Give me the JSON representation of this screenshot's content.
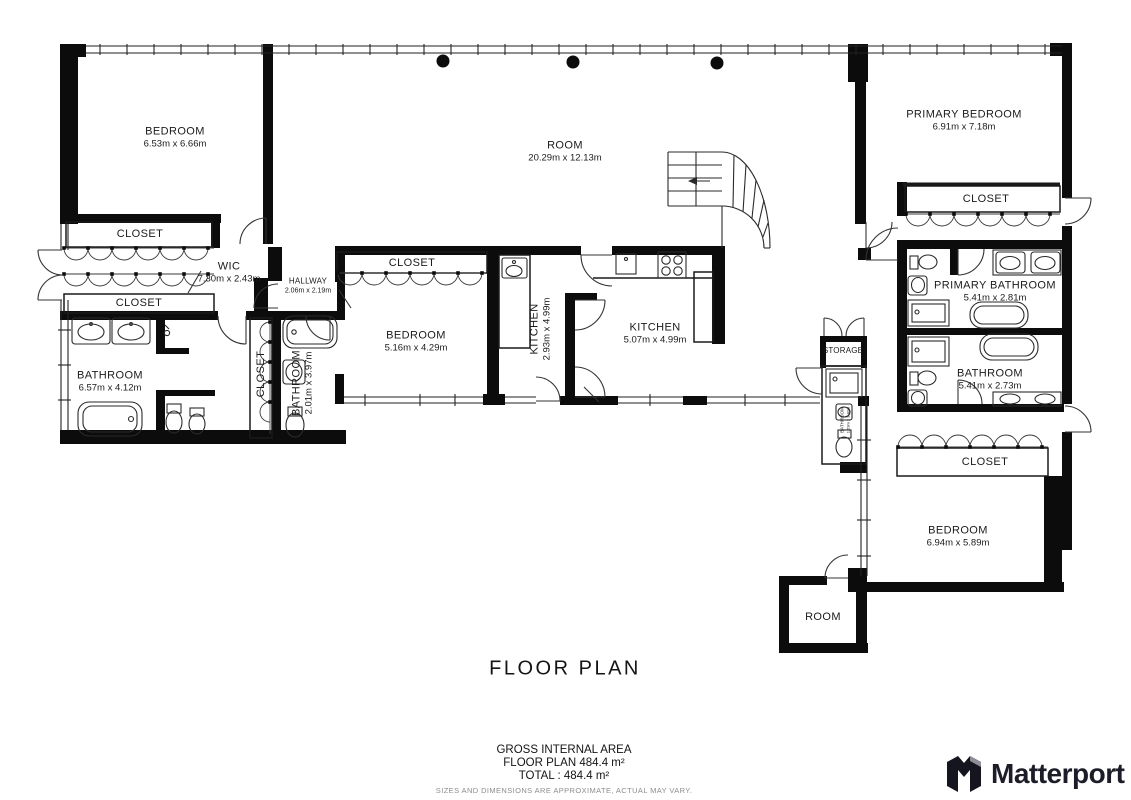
{
  "title": "FLOOR PLAN",
  "footer": {
    "gross_internal_area": "GROSS INTERNAL AREA",
    "floor_plan_area": "FLOOR PLAN 484.4 m²",
    "total_area": "TOTAL :  484.4 m²",
    "disclaimer": "SIZES AND DIMENSIONS ARE APPROXIMATE, ACTUAL MAY VARY."
  },
  "branding": {
    "logo_text": "Matterport"
  },
  "colors": {
    "wall": "#0c0c0c",
    "line": "#2a2a2a",
    "text": "#1b1b1b",
    "muted": "#8d8d8d"
  },
  "rooms": [
    {
      "id": "bedroom-left",
      "name": "BEDROOM",
      "dims": "6.53m x 6.66m"
    },
    {
      "id": "closet-left-upper",
      "name": "CLOSET",
      "dims": ""
    },
    {
      "id": "wic",
      "name": "WIC",
      "dims": "7.30m x 2.43m"
    },
    {
      "id": "closet-left-lower",
      "name": "CLOSET",
      "dims": ""
    },
    {
      "id": "hallway",
      "name": "HALLWAY",
      "dims": "2.06m x 2.19m"
    },
    {
      "id": "bathroom-left",
      "name": "BATHROOM",
      "dims": "6.57m x 4.12m"
    },
    {
      "id": "closet-vertical",
      "name": "CLOSET",
      "dims": ""
    },
    {
      "id": "bathroom-inner",
      "name": "BATHROOM",
      "dims": "2.01m x 3.97m"
    },
    {
      "id": "closet-middle",
      "name": "CLOSET",
      "dims": ""
    },
    {
      "id": "bedroom-middle",
      "name": "BEDROOM",
      "dims": "5.16m x 4.29m"
    },
    {
      "id": "kitchen-small",
      "name": "KITCHEN",
      "dims": "2.93m x 4.99m"
    },
    {
      "id": "kitchen-main",
      "name": "KITCHEN",
      "dims": "5.07m x 4.99m"
    },
    {
      "id": "room-main",
      "name": "ROOM",
      "dims": "20.29m x 12.13m"
    },
    {
      "id": "primary-bedroom",
      "name": "PRIMARY BEDROOM",
      "dims": "6.91m x 7.18m"
    },
    {
      "id": "closet-primary",
      "name": "CLOSET",
      "dims": ""
    },
    {
      "id": "primary-bathroom",
      "name": "PRIMARY BATHROOM",
      "dims": "5.41m x 2.81m"
    },
    {
      "id": "bathroom-right",
      "name": "BATHROOM",
      "dims": "5.41m x 2.73m"
    },
    {
      "id": "storage",
      "name": "STORAGE",
      "dims": ""
    },
    {
      "id": "bathroom-small",
      "name": "BATHROOM",
      "dims": "1.29m x 3.40m"
    },
    {
      "id": "closet-right",
      "name": "CLOSET",
      "dims": ""
    },
    {
      "id": "bedroom-right",
      "name": "BEDROOM",
      "dims": "6.94m x 5.89m"
    },
    {
      "id": "room-small",
      "name": "ROOM",
      "dims": ""
    }
  ]
}
